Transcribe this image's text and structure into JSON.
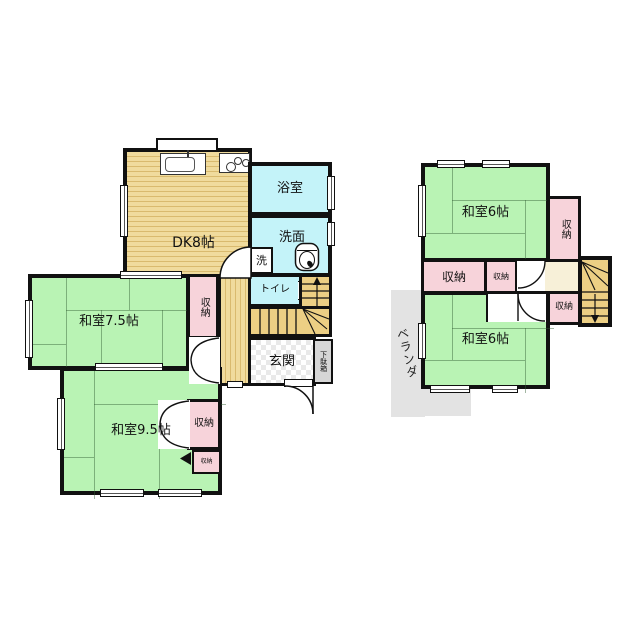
{
  "floor1": {
    "dk_label": "DK8帖",
    "bath_label": "浴室",
    "washroom_label": "洗面",
    "laundry_label": "洗",
    "toilet_label": "トイレ",
    "washitsu_75_label": "和室7.5帖",
    "washitsu_95_label": "和室9.5帖",
    "closet_hall_label": "収納",
    "closet_95_label": "収納",
    "closet_95_small_label": "収納",
    "genkan_label": "玄関",
    "getabako_label": "下駄箱"
  },
  "floor2": {
    "washitsu_top_label": "和室6帖",
    "washitsu_bottom_label": "和室6帖",
    "closet_right_label": "収納",
    "closet_left_label": "収納",
    "closet_mid_label": "収納",
    "closet_stair_label": "収納",
    "veranda_label": "ベランダ"
  },
  "colors": {
    "tatami_green": "#b9f3b4",
    "wood_tan": "#f0db9d",
    "water_cyan": "#c4f3f9",
    "closet_pink": "#f7d3da",
    "hall_cream": "#f7f0d8",
    "stair_tan": "#eccf84",
    "veranda_gray": "#e3e3e3",
    "wall_black": "#111111"
  }
}
